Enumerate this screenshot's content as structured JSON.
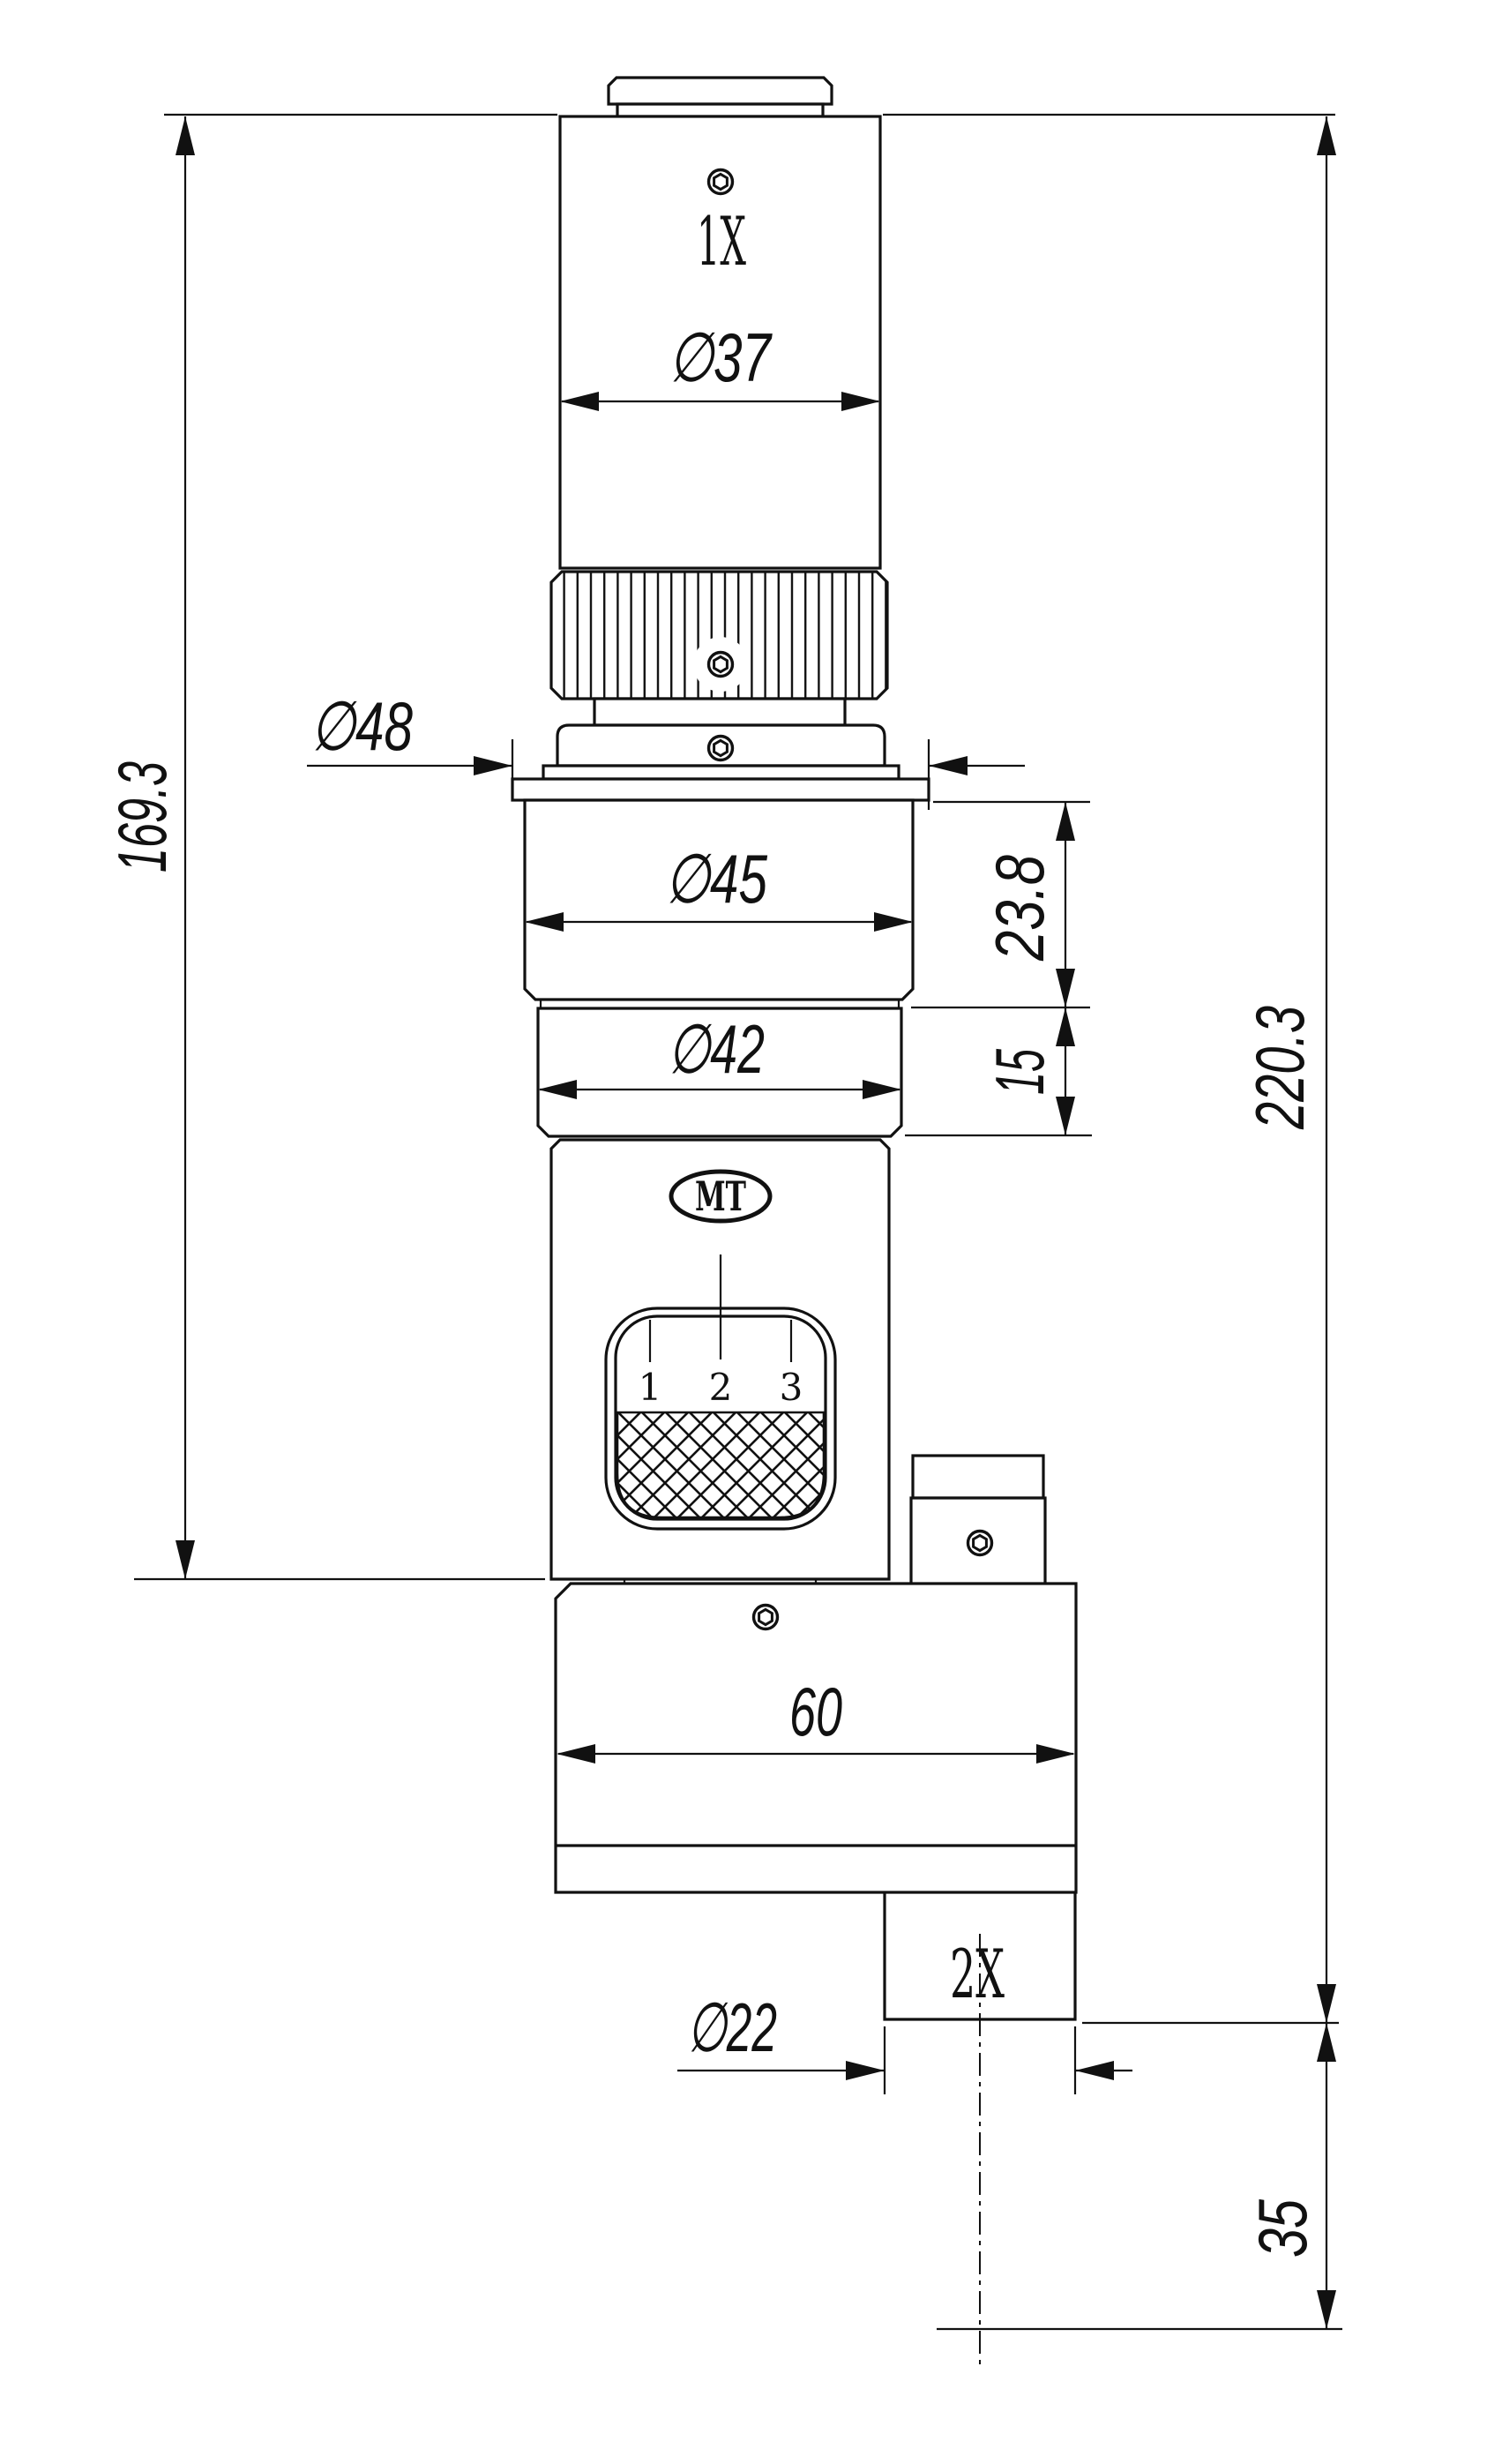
{
  "title": "Microscope zoom lens adapter - dimensioned engineering drawing",
  "labels": {
    "top_magnification": "1X",
    "side_magnification": "2X",
    "logo": "MT",
    "window_marks": [
      "1",
      "2",
      "3"
    ]
  },
  "dimensions": {
    "barrel_diameter": "∅37",
    "flange_diameter": "∅48",
    "upper_body_diameter": "∅45",
    "lower_body_diameter": "∅42",
    "port_diameter": "∅22",
    "upper_body_height": "23.8",
    "lower_body_height": "15",
    "block_width": "60",
    "left_overall_height": "169.3",
    "right_overall_height": "220.3",
    "port_bottom_offset": "35"
  },
  "colors": {
    "line": "#111111",
    "background": "#ffffff"
  }
}
